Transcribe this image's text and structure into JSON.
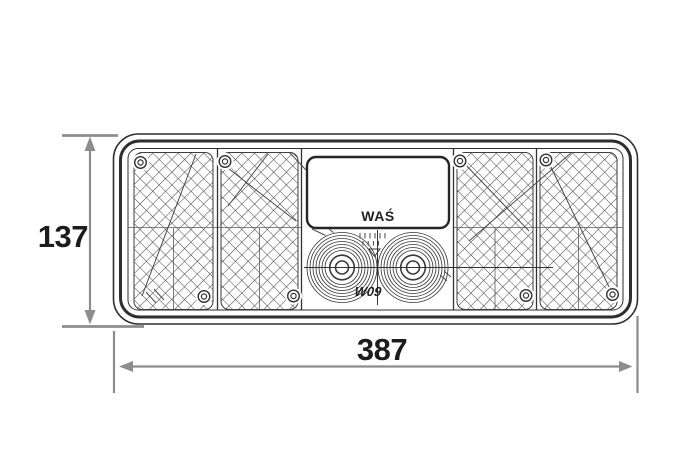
{
  "document": {
    "type": "technical-drawing",
    "subject": "trailer rear combination lamp, front view",
    "labels": {
      "brand": "WAŚ",
      "model": "W09",
      "height_mm": "137",
      "width_mm": "387"
    },
    "colors": {
      "background": "#ffffff",
      "outline": "#2e2e2e",
      "dimension_line": "#8d8d8d",
      "label_text": "#1c1c1c"
    }
  }
}
